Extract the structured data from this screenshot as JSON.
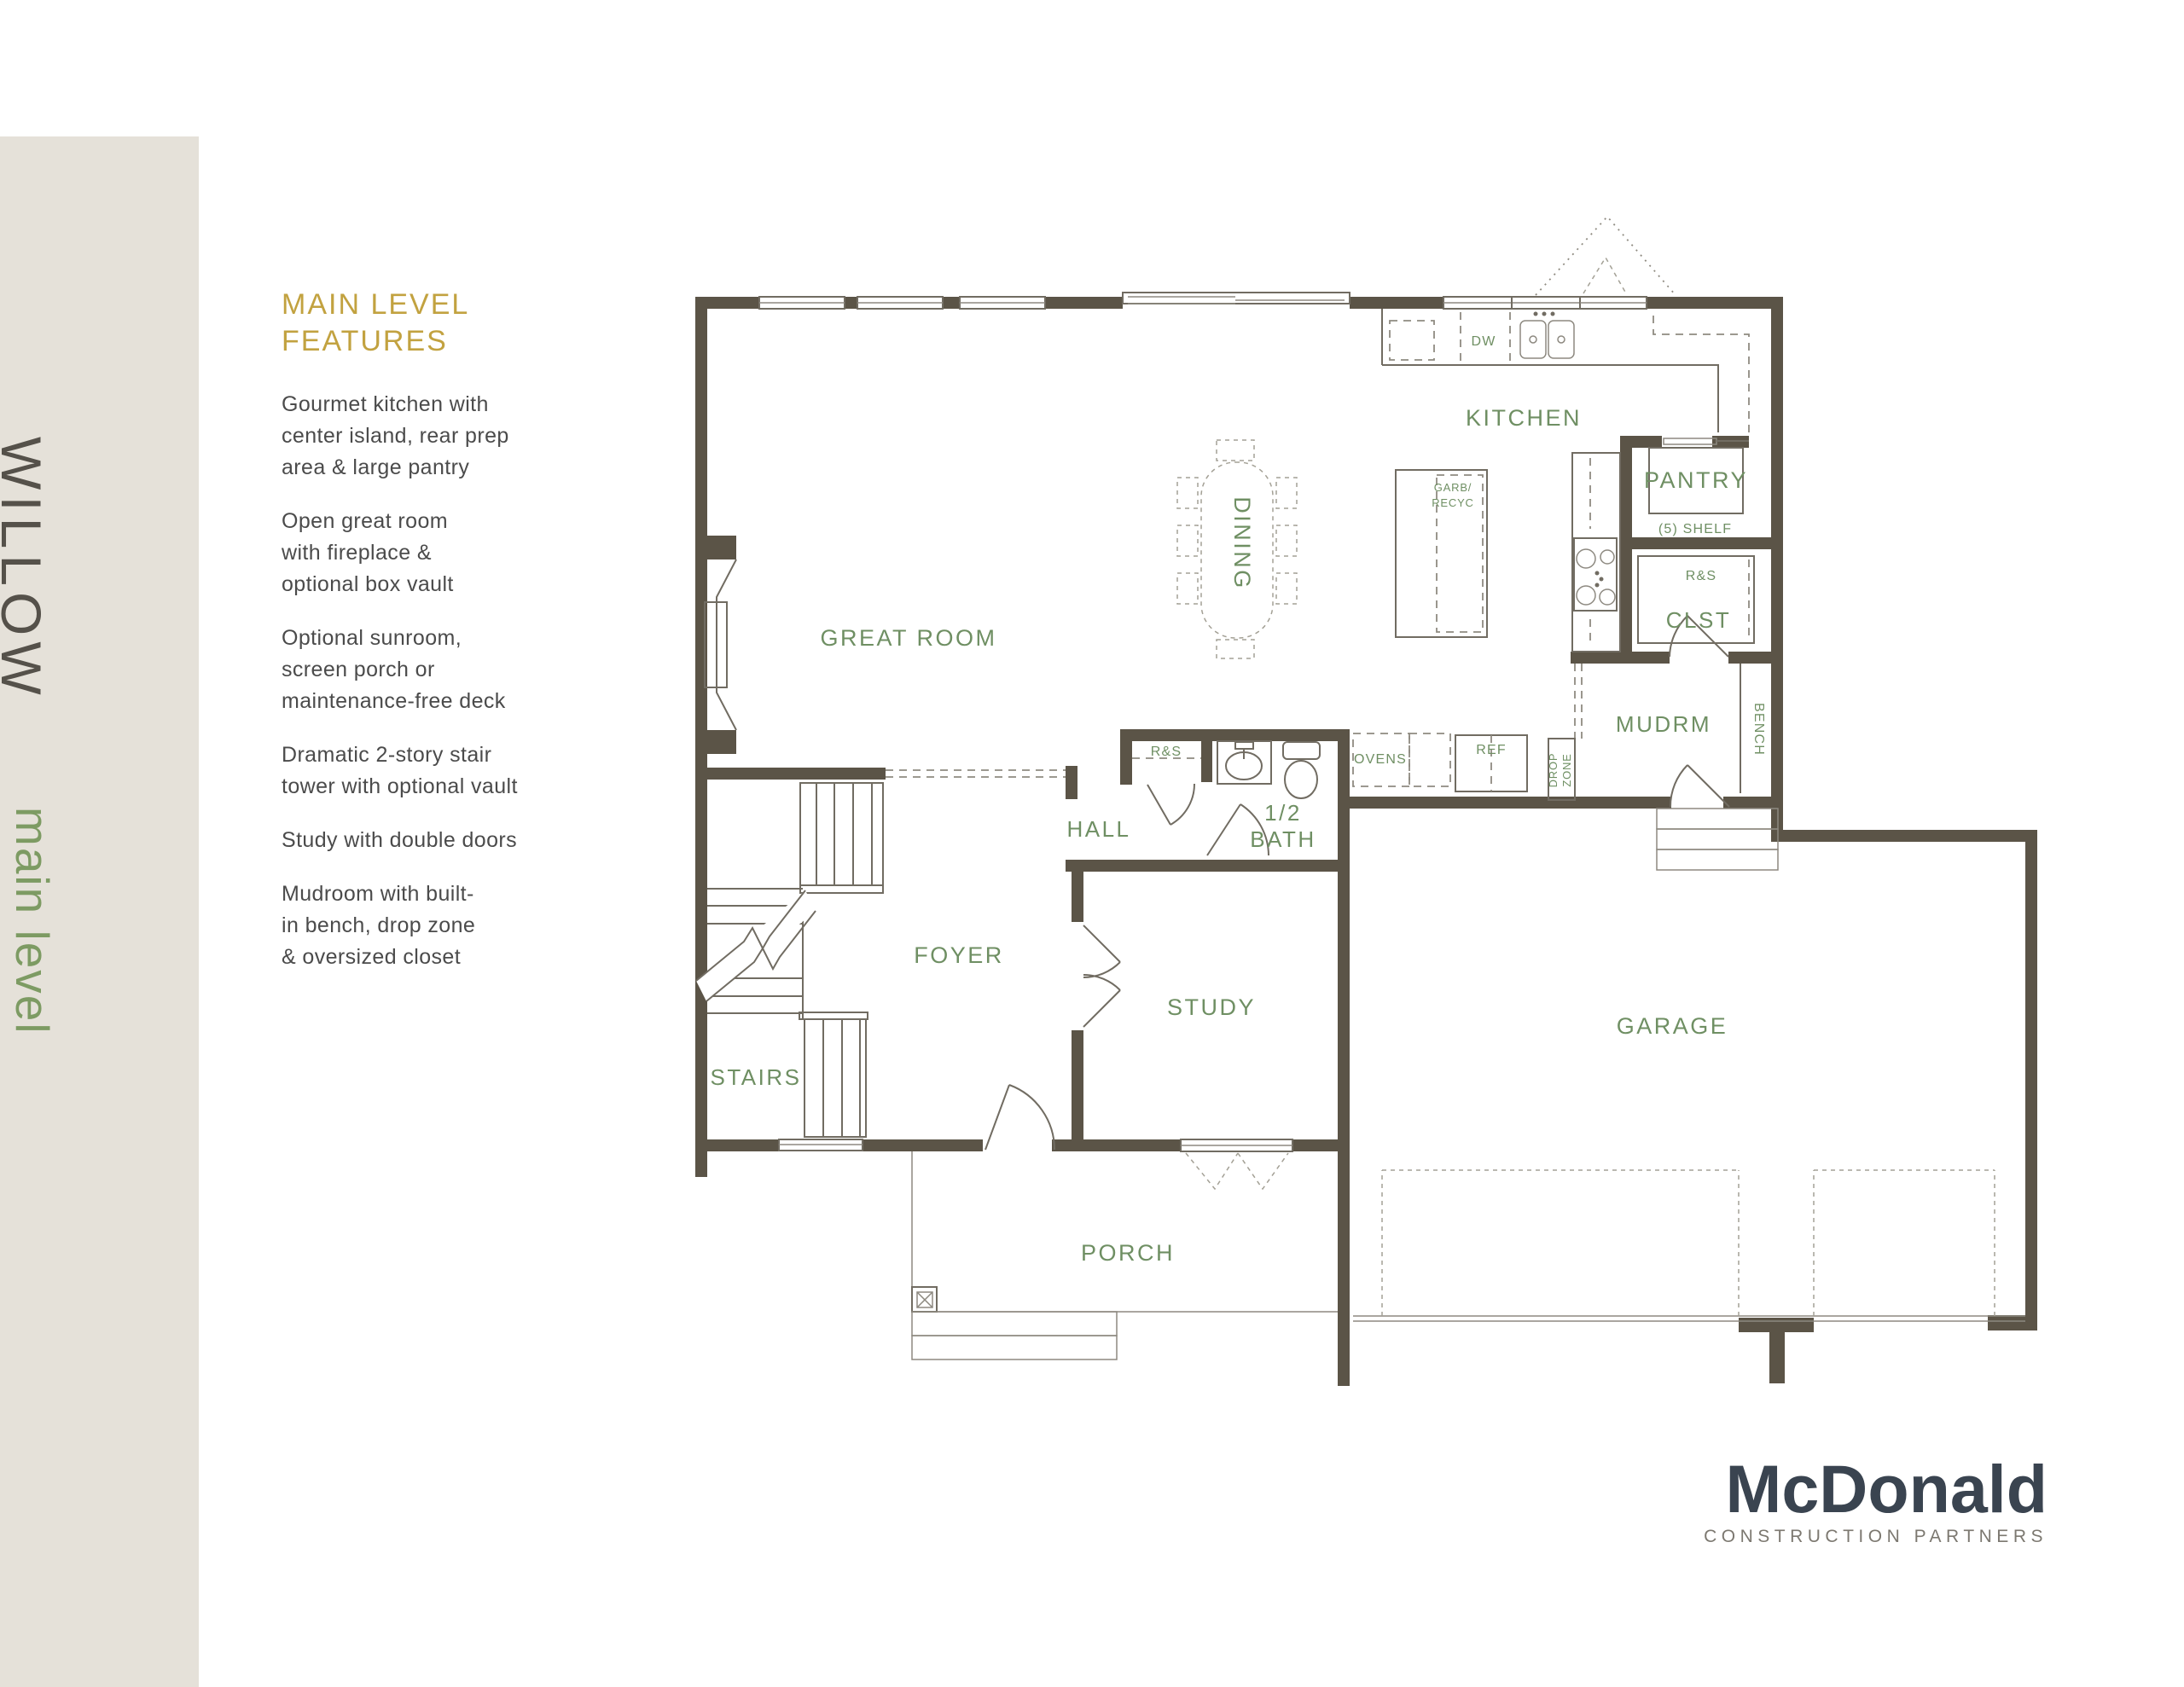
{
  "sidebar": {
    "title": "WILLOW",
    "subtitle": "main level"
  },
  "features": {
    "heading": "MAIN LEVEL\nFEATURES",
    "items": [
      "Gourmet kitchen with\ncenter island, rear prep\narea & large pantry",
      "Open great room\nwith fireplace &\noptional box vault",
      "Optional sunroom,\nscreen porch or\nmaintenance-free deck",
      "Dramatic 2-story stair\ntower with optional vault",
      "Study with double doors",
      "Mudroom with built-\nin bench, drop zone\n& oversized closet"
    ]
  },
  "plan": {
    "labels": {
      "great_room": "GREAT ROOM",
      "dining": "DINING",
      "kitchen": "KITCHEN",
      "dw": "DW",
      "garb_line1": "GARB/",
      "garb_line2": "RECYC",
      "pantry": "PANTRY",
      "pantry_shelf": "(5) SHELF",
      "closet_rod_shelf": "R&S",
      "closet": "CLST",
      "mudroom": "MUDRM",
      "bench": "BENCH",
      "drop_zone_line1": "DROP",
      "drop_zone_line2": "ZONE",
      "ref": "REF",
      "ovens": "OVENS",
      "hall_closet_rod_shelf": "R&S",
      "hall": "HALL",
      "half_bath_line1": "1/2",
      "half_bath_line2": "BATH",
      "foyer": "FOYER",
      "stairs": "STAIRS",
      "study": "STUDY",
      "porch": "PORCH",
      "garage": "GARAGE"
    }
  },
  "logo": {
    "name": "McDonald",
    "tagline": "CONSTRUCTION PARTNERS"
  },
  "colors": {
    "wall": "#5b5447",
    "label_green": "#6f8f63",
    "heading_gold": "#c2a240",
    "sidebar_bg": "#e5e1d9",
    "sidebar_title": "#55514a",
    "sidebar_subtitle": "#7d9b63",
    "logo_navy": "#3a4450",
    "logo_gray": "#7c7870"
  }
}
